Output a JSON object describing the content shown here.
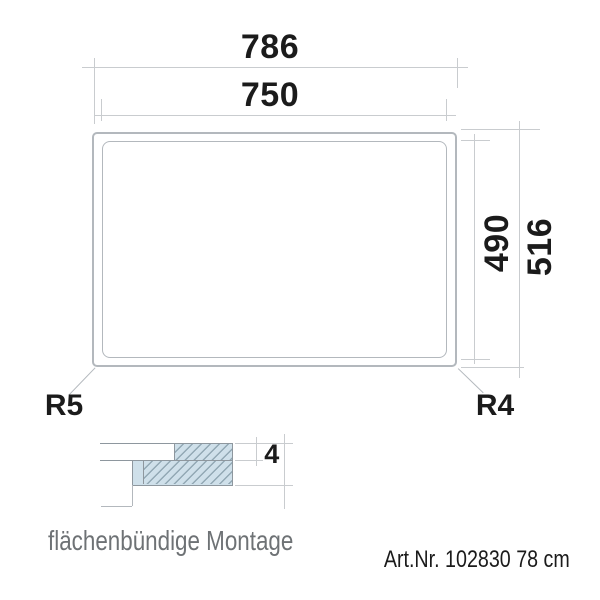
{
  "drawing": {
    "outer_width_mm": "786",
    "cutout_width_mm": "750",
    "cutout_height_mm": "490",
    "outer_height_mm": "516",
    "corner_radius_bottom_left": "R5",
    "corner_radius_bottom_right": "R4"
  },
  "section_detail": {
    "glass_thickness_mm": "4",
    "caption": "flächenbündige Montage"
  },
  "footer": {
    "article_number": "Art.Nr. 102830 78 cm"
  },
  "colors": {
    "dim_text": "#1b1b1b",
    "caption_text": "#6e7275",
    "line": "#b3b8bd",
    "dim_line": "#c9cccf",
    "section_line": "#8e979e",
    "hatch_fill": "#cfe0ea",
    "hatch_line": "#92a8b4"
  }
}
